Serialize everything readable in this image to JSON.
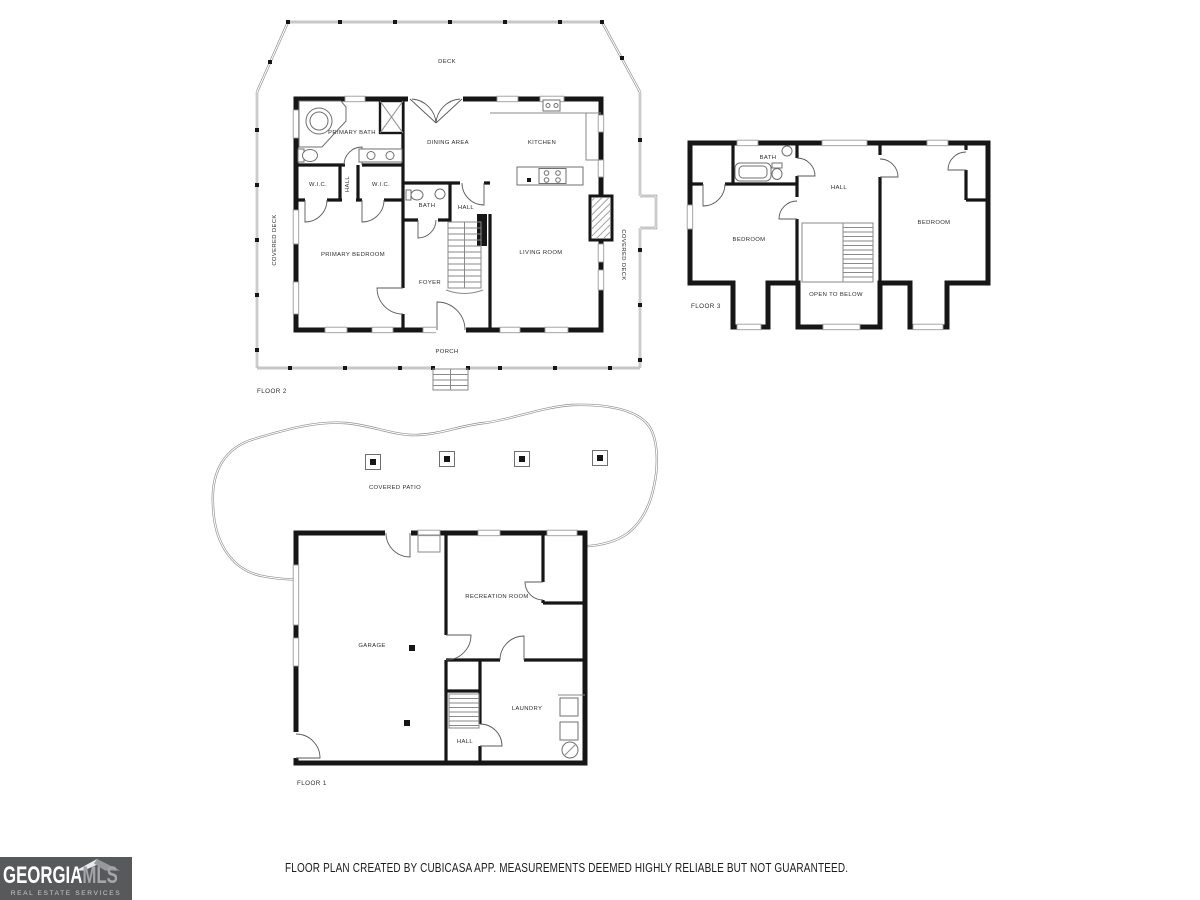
{
  "colors": {
    "wall": "#161616",
    "thin_line": "#8a8a8a",
    "label_text": "#2e2e2e",
    "logo_background": "#58595b",
    "logo_primary_text": "#ffffff",
    "logo_secondary_text": "#a4a6a9",
    "logo_tagline_text": "#c9cacc",
    "footer_text": "#1c1c1c"
  },
  "floor2": {
    "label": "FLOOR 2",
    "rooms": {
      "deck": "DECK",
      "primary_bath": "PRIMARY BATH",
      "dining_area": "DINING AREA",
      "kitchen": "KITCHEN",
      "wic_left": "W.I.C.",
      "closet_hall": "HALL",
      "wic_right": "W.I.C.",
      "bath": "BATH",
      "hall": "HALL",
      "primary_bedroom": "PRIMARY BEDROOM",
      "foyer": "FOYER",
      "living_room": "LIVING ROOM",
      "covered_deck_left": "COVERED DECK",
      "covered_deck_right": "COVERED DECK",
      "porch": "PORCH"
    }
  },
  "floor3": {
    "label": "FLOOR 3",
    "rooms": {
      "bath": "BATH",
      "hall": "HALL",
      "bedroom_left": "BEDROOM",
      "bedroom_right": "BEDROOM",
      "open_to_below": "OPEN TO BELOW"
    }
  },
  "floor1": {
    "label": "FLOOR 1",
    "rooms": {
      "covered_patio": "COVERED PATIO",
      "garage": "GARAGE",
      "recreation_room": "RECREATION ROOM",
      "laundry": "LAUNDRY",
      "hall": "HALL"
    }
  },
  "footer": {
    "disclaimer": "FLOOR PLAN CREATED BY CUBICASA APP. MEASUREMENTS DEEMED HIGHLY RELIABLE BUT NOT GUARANTEED."
  },
  "logo": {
    "brand_primary": "GEORGIA",
    "brand_secondary": "MLS",
    "tagline": "REAL ESTATE SERVICES"
  }
}
